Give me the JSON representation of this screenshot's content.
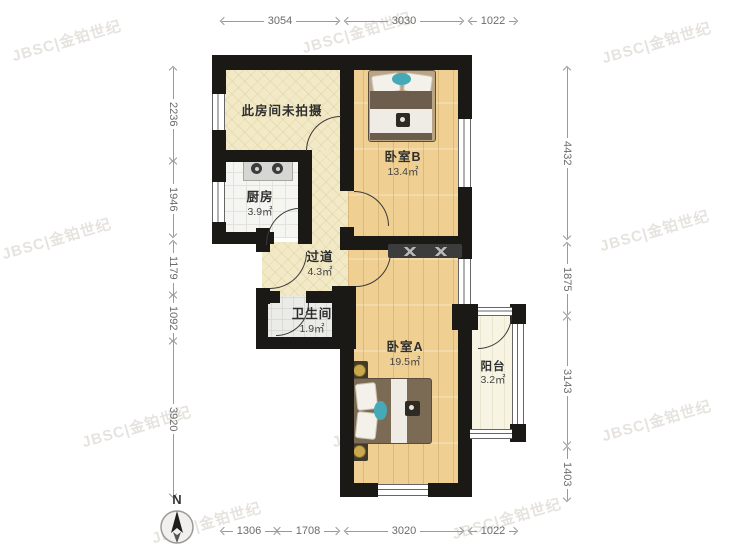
{
  "watermark": {
    "text": "JBSC|金铂世纪"
  },
  "compass": {
    "north_label": "N"
  },
  "rooms": {
    "unphotographed": {
      "name": "此房间未拍摄"
    },
    "kitchen": {
      "name": "厨房",
      "area": "3.9㎡"
    },
    "bedroom_b": {
      "name": "卧室B",
      "area": "13.4㎡"
    },
    "hallway": {
      "name": "过道",
      "area": "4.3㎡"
    },
    "bathroom": {
      "name": "卫生间",
      "area": "1.9㎡"
    },
    "bedroom_a": {
      "name": "卧室A",
      "area": "19.5㎡"
    },
    "balcony": {
      "name": "阳台",
      "area": "3.2㎡"
    }
  },
  "dims": {
    "top": [
      "3054",
      "3030",
      "1022"
    ],
    "bottom": [
      "1306",
      "1708",
      "3020",
      "1022"
    ],
    "left": [
      "2236",
      "1946",
      "1179",
      "1092",
      "3920"
    ],
    "right": [
      "4432",
      "1875",
      "3143",
      "1403"
    ]
  },
  "colors": {
    "wall": "#1b1916",
    "wood_floor": "#f0d092",
    "cream_floor": "#f2e9c6",
    "teal_accent": "#45a9b8"
  }
}
